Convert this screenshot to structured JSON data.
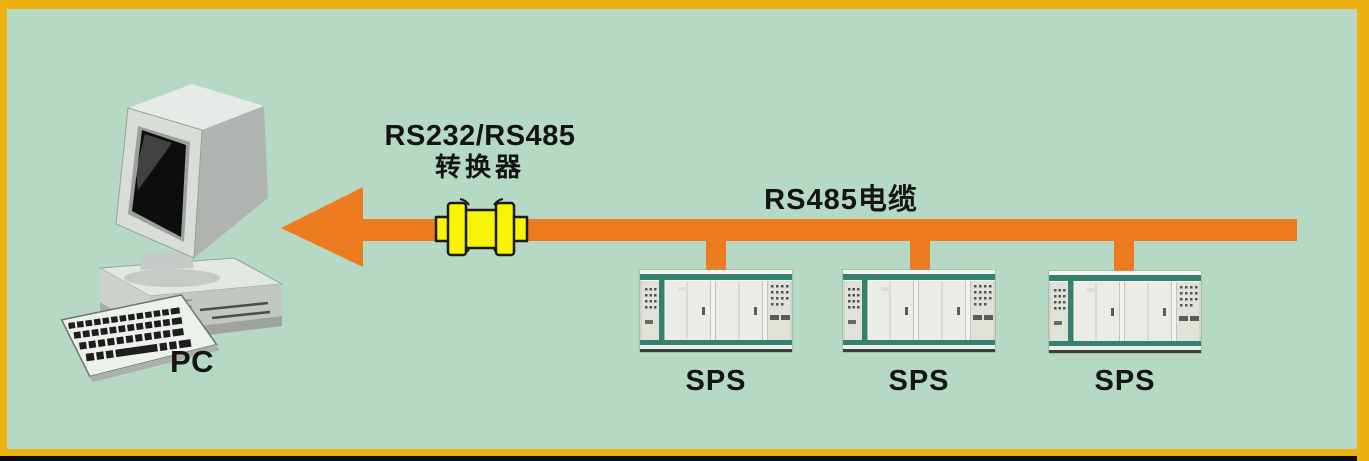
{
  "frame": {
    "background_color": "#b5d9c4",
    "border_color": "#ecb00f",
    "bottom_bar_color": "#0d0d0d"
  },
  "pc": {
    "label": "PC"
  },
  "converter": {
    "label_line1": "RS232/RS485",
    "label_line2": "转换器",
    "color": "#f8f303"
  },
  "cable": {
    "label": "RS485电缆",
    "color": "#ec7c1f"
  },
  "sps_units": [
    {
      "label": "SPS"
    },
    {
      "label": "SPS"
    },
    {
      "label": "SPS"
    }
  ]
}
